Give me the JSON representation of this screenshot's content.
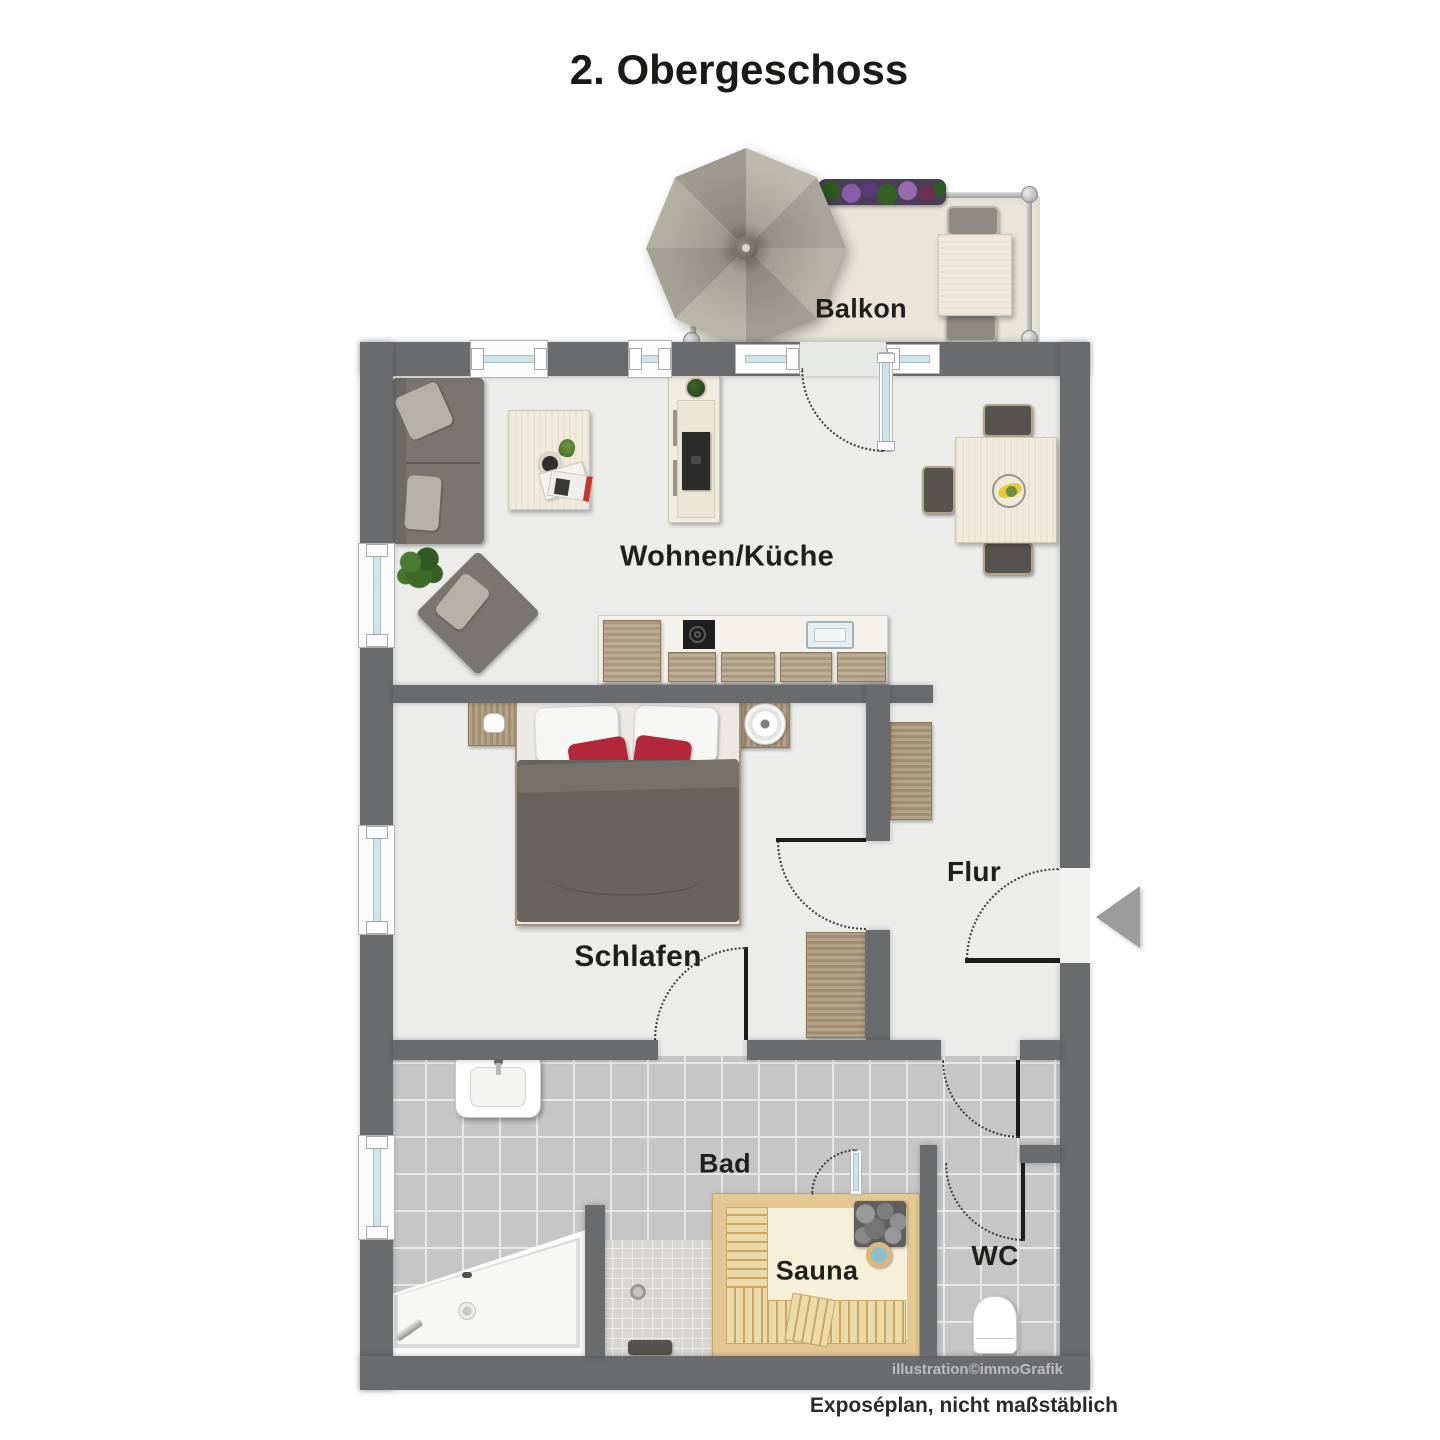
{
  "title": "2. Obergeschoss",
  "rooms": {
    "balkon": "Balkon",
    "wohnen_kueche": "Wohnen/Küche",
    "schlafen": "Schlafen",
    "flur": "Flur",
    "bad": "Bad",
    "sauna": "Sauna",
    "wc": "WC"
  },
  "footer": {
    "credit": "illustration©immoGrafik",
    "disclaimer": "Exposéplan, nicht maßstäblich"
  },
  "colors": {
    "wall": "#6a6b6d",
    "floor": "#ecedeb",
    "balcony_floor": "#e9e5d8",
    "tile": "#c6c6c6",
    "grout": "#e8e8e6",
    "mosaic_tile": "#d7d6d2",
    "wood": "#ab9678",
    "counter": "#f3f1ea",
    "sauna_frame": "#e4c792",
    "sauna_floor": "#f8efd8",
    "bench_wood": "#eddaa9",
    "duvet": "#67635f",
    "pillow_red": "#b3273a",
    "sofa": "#7a7570",
    "window_glass": "#cfe4ea",
    "door_leaf": "#1c1c1c",
    "label_text": "#1f1f1d",
    "credit_text": "#bcbcbc",
    "entry_arrow": "#9c9c9c",
    "umbrella_light": "#bdb9ac",
    "umbrella_dark": "#a5a196",
    "plant_green": "#3e6b2a",
    "flower_purple": "#8a5ca8"
  }
}
